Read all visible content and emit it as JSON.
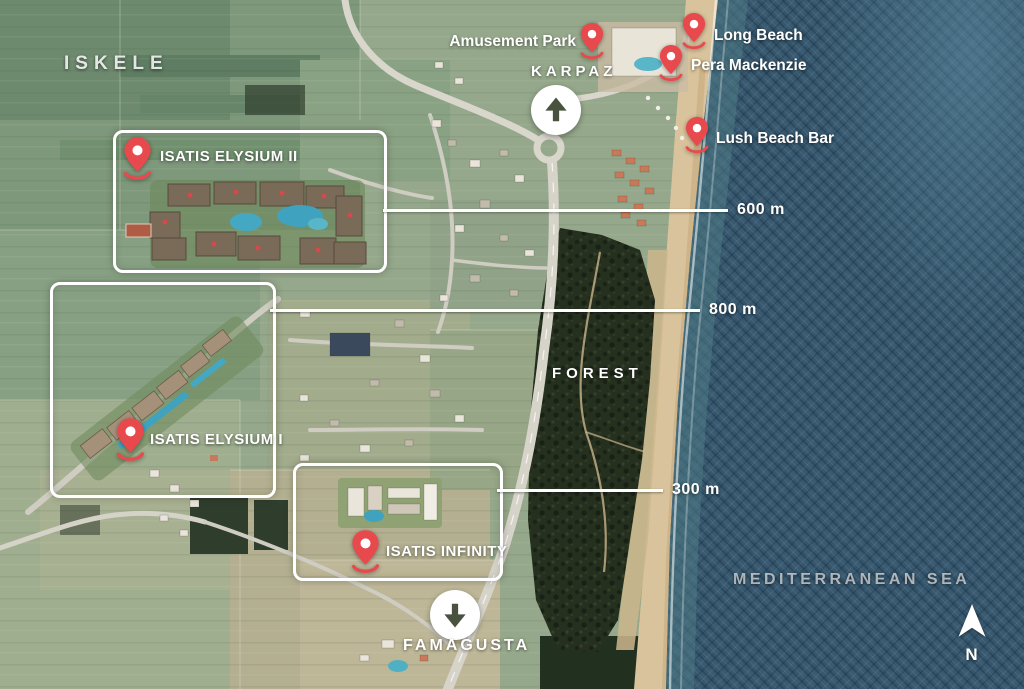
{
  "region": {
    "iskele": "ISKELE",
    "forest": "FOREST",
    "sea": "MEDITERRANEAN SEA"
  },
  "markers": {
    "karpaz": {
      "label": "KARPAZ",
      "direction": "up"
    },
    "famagusta": {
      "label": "FAMAGUSTA",
      "direction": "down"
    }
  },
  "projects": [
    {
      "id": "isatis-elysium-ii",
      "name": "ISATIS ELYSIUM II"
    },
    {
      "id": "isatis-elysium-i",
      "name": "ISATIS ELYSIUM I"
    },
    {
      "id": "isatis-infinity",
      "name": "ISATIS INFINITY"
    }
  ],
  "pois": [
    {
      "id": "amusement-park",
      "name": "Amusement Park",
      "label_side": "left"
    },
    {
      "id": "long-beach",
      "name": "Long Beach",
      "label_side": "right"
    },
    {
      "id": "pera-mackenzie",
      "name": "Pera Mackenzie",
      "label_side": "right"
    },
    {
      "id": "lush-beach-bar",
      "name": "Lush Beach Bar",
      "label_side": "right"
    }
  ],
  "distances": [
    {
      "id": "d600",
      "label": "600 m"
    },
    {
      "id": "d800",
      "label": "800 m"
    },
    {
      "id": "d300",
      "label": "300 m"
    }
  ],
  "compass": {
    "label": "N"
  },
  "colors": {
    "pin_red": "#e8494d",
    "arrow_olive": "#49523f",
    "line_white": "#ffffff",
    "sea_base": "#35566d",
    "forest_dark": "#26301f",
    "field_green": "#8ea387",
    "beach_sand": "#d9c39c"
  }
}
